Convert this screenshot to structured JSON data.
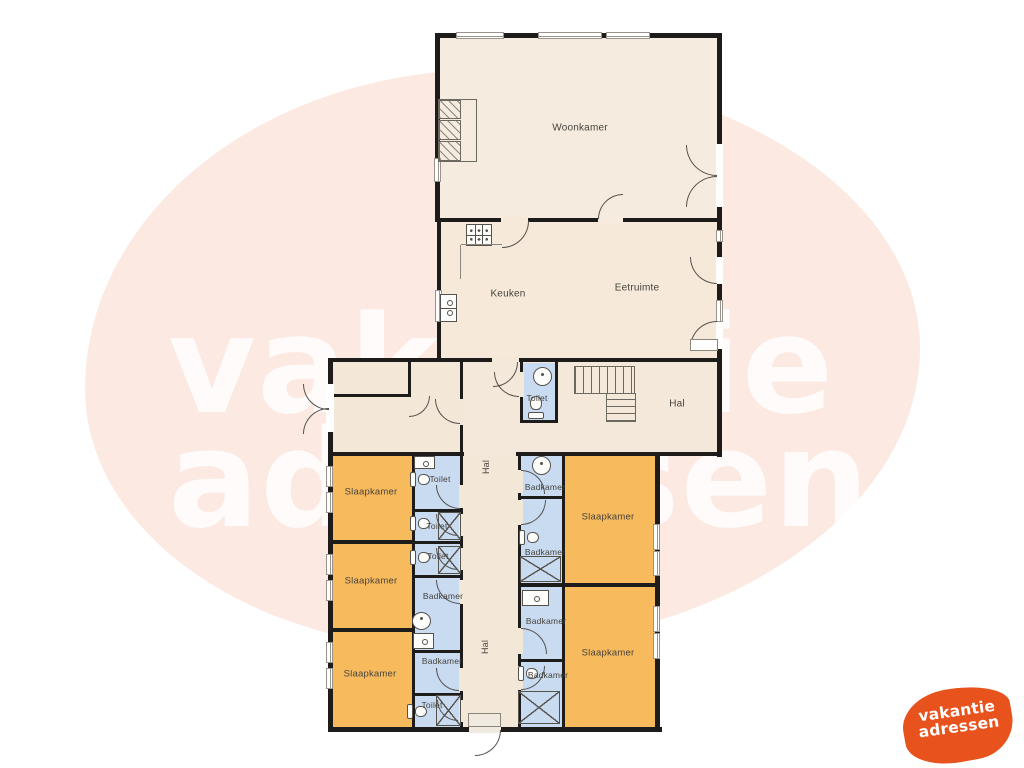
{
  "watermark": {
    "line1": "vakantie",
    "line2": "adressen",
    "color": "rgba(255,255,255,0.82)"
  },
  "background": {
    "blob_color": "#fbe9e2"
  },
  "logo": {
    "line1": "vakantie",
    "line2": "adressen",
    "shape_color": "#e8521c",
    "text_color": "#ffffff"
  },
  "palette": {
    "wall": "#1d1c1a",
    "floor_cream": "#f5ecdf",
    "floor_warm": "#f6e9d9",
    "floor_hall": "#f3e7d8",
    "bedroom_orange": "#f7bb5e",
    "bathroom_blue": "#c9dbf1"
  },
  "floorplan": {
    "rooms": [
      {
        "name": "woonkamer",
        "x": 438,
        "y": 36,
        "w": 281,
        "h": 184,
        "fill": "#f5ecdf"
      },
      {
        "name": "keuken-eetruimte",
        "x": 440,
        "y": 220,
        "w": 279,
        "h": 140,
        "fill": "#f6e9d9"
      },
      {
        "name": "hal-boven",
        "x": 461,
        "y": 360,
        "w": 258,
        "h": 94,
        "fill": "#f4e8da"
      },
      {
        "name": "entree",
        "x": 331,
        "y": 360,
        "w": 130,
        "h": 94,
        "fill": "#f3e7d8"
      },
      {
        "name": "toilet-midden",
        "x": 521,
        "y": 363,
        "w": 36,
        "h": 59,
        "fill": "#c9dbf1"
      },
      {
        "name": "hal-midden",
        "x": 461,
        "y": 454,
        "w": 59,
        "h": 275,
        "fill": "#f3e7d8"
      },
      {
        "name": "slaapkamer-1",
        "x": 331,
        "y": 454,
        "w": 83,
        "h": 88,
        "fill": "#f7bb5e"
      },
      {
        "name": "slaapkamer-2",
        "x": 331,
        "y": 542,
        "w": 83,
        "h": 88,
        "fill": "#f7bb5e"
      },
      {
        "name": "slaapkamer-3",
        "x": 331,
        "y": 632,
        "w": 83,
        "h": 97,
        "fill": "#f7bb5e"
      },
      {
        "name": "toilet-l1",
        "x": 413,
        "y": 454,
        "w": 49,
        "h": 57,
        "fill": "#c9dbf1"
      },
      {
        "name": "toilet-l2",
        "x": 413,
        "y": 511,
        "w": 49,
        "h": 32,
        "fill": "#c9dbf1"
      },
      {
        "name": "toilet-l3",
        "x": 413,
        "y": 543,
        "w": 49,
        "h": 34,
        "fill": "#c9dbf1"
      },
      {
        "name": "badkamer-l4",
        "x": 413,
        "y": 577,
        "w": 49,
        "h": 75,
        "fill": "#c9dbf1"
      },
      {
        "name": "badkamer-l5",
        "x": 413,
        "y": 652,
        "w": 49,
        "h": 43,
        "fill": "#c9dbf1"
      },
      {
        "name": "toilet-l6",
        "x": 413,
        "y": 695,
        "w": 49,
        "h": 34,
        "fill": "#c9dbf1"
      },
      {
        "name": "badkamer-r1",
        "x": 519,
        "y": 454,
        "w": 45,
        "h": 44,
        "fill": "#c9dbf1"
      },
      {
        "name": "badkamer-r2",
        "x": 519,
        "y": 498,
        "w": 45,
        "h": 87,
        "fill": "#c9dbf1"
      },
      {
        "name": "badkamer-r3",
        "x": 519,
        "y": 585,
        "w": 45,
        "h": 76,
        "fill": "#c9dbf1"
      },
      {
        "name": "badkamer-r4",
        "x": 519,
        "y": 661,
        "w": 45,
        "h": 68,
        "fill": "#c9dbf1"
      },
      {
        "name": "slaapkamer-4",
        "x": 563,
        "y": 454,
        "w": 93,
        "h": 130,
        "fill": "#f7bb5e"
      },
      {
        "name": "slaapkamer-5",
        "x": 563,
        "y": 584,
        "w": 93,
        "h": 145,
        "fill": "#f7bb5e"
      }
    ],
    "walls": [
      {
        "x": 435,
        "y": 33,
        "w": 287,
        "h": 5
      },
      {
        "x": 435,
        "y": 33,
        "w": 5,
        "h": 189
      },
      {
        "x": 437,
        "y": 220,
        "w": 4,
        "h": 142
      },
      {
        "x": 717,
        "y": 33,
        "w": 5,
        "h": 424
      },
      {
        "x": 435,
        "y": 218,
        "w": 284,
        "h": 4
      },
      {
        "x": 328,
        "y": 358,
        "w": 394,
        "h": 4
      },
      {
        "x": 328,
        "y": 358,
        "w": 5,
        "h": 374
      },
      {
        "x": 328,
        "y": 727,
        "w": 334,
        "h": 5
      },
      {
        "x": 655,
        "y": 455,
        "w": 5,
        "h": 276
      },
      {
        "x": 328,
        "y": 452,
        "w": 136,
        "h": 4
      },
      {
        "x": 516,
        "y": 452,
        "w": 206,
        "h": 4
      },
      {
        "x": 412,
        "y": 454,
        "w": 3,
        "h": 273
      },
      {
        "x": 460,
        "y": 358,
        "w": 3,
        "h": 369
      },
      {
        "x": 518,
        "y": 454,
        "w": 3,
        "h": 273
      },
      {
        "x": 562,
        "y": 454,
        "w": 3,
        "h": 273
      },
      {
        "x": 520,
        "y": 362,
        "w": 3,
        "h": 60
      },
      {
        "x": 555,
        "y": 362,
        "w": 3,
        "h": 60
      },
      {
        "x": 520,
        "y": 420,
        "w": 38,
        "h": 3
      },
      {
        "x": 408,
        "y": 360,
        "w": 3,
        "h": 36
      },
      {
        "x": 328,
        "y": 394,
        "w": 83,
        "h": 3
      },
      {
        "x": 412,
        "y": 509,
        "w": 50,
        "h": 3
      },
      {
        "x": 412,
        "y": 541,
        "w": 50,
        "h": 3
      },
      {
        "x": 412,
        "y": 575,
        "w": 50,
        "h": 3
      },
      {
        "x": 412,
        "y": 650,
        "w": 50,
        "h": 3
      },
      {
        "x": 412,
        "y": 693,
        "w": 50,
        "h": 3
      },
      {
        "x": 328,
        "y": 540,
        "w": 87,
        "h": 4
      },
      {
        "x": 328,
        "y": 628,
        "w": 87,
        "h": 4
      },
      {
        "x": 518,
        "y": 496,
        "w": 47,
        "h": 3
      },
      {
        "x": 518,
        "y": 583,
        "w": 140,
        "h": 4
      },
      {
        "x": 518,
        "y": 659,
        "w": 47,
        "h": 3
      }
    ],
    "gaps": [
      {
        "x": 501,
        "y": 217,
        "w": 27,
        "h": 6,
        "fill": "#f6e9d9"
      },
      {
        "x": 598,
        "y": 217,
        "w": 25,
        "h": 6,
        "fill": "#f5ecdf"
      },
      {
        "x": 492,
        "y": 357,
        "w": 27,
        "h": 6,
        "fill": "#f4e8da"
      },
      {
        "x": 519,
        "y": 372,
        "w": 5,
        "h": 25,
        "fill": "#f4e8da"
      },
      {
        "x": 459,
        "y": 399,
        "w": 6,
        "h": 26,
        "fill": "#f3e7d8"
      },
      {
        "x": 459,
        "y": 485,
        "w": 6,
        "h": 23,
        "fill": "#f3e7d8"
      },
      {
        "x": 459,
        "y": 514,
        "w": 6,
        "h": 22,
        "fill": "#f3e7d8"
      },
      {
        "x": 459,
        "y": 548,
        "w": 6,
        "h": 22,
        "fill": "#f3e7d8"
      },
      {
        "x": 459,
        "y": 580,
        "w": 6,
        "h": 24,
        "fill": "#f3e7d8"
      },
      {
        "x": 459,
        "y": 668,
        "w": 6,
        "h": 23,
        "fill": "#f3e7d8"
      },
      {
        "x": 459,
        "y": 700,
        "w": 6,
        "h": 22,
        "fill": "#f3e7d8"
      },
      {
        "x": 517,
        "y": 470,
        "w": 6,
        "h": 23,
        "fill": "#f3e7d8"
      },
      {
        "x": 517,
        "y": 500,
        "w": 6,
        "h": 25,
        "fill": "#f3e7d8"
      },
      {
        "x": 517,
        "y": 628,
        "w": 6,
        "h": 26,
        "fill": "#f3e7d8"
      },
      {
        "x": 517,
        "y": 666,
        "w": 6,
        "h": 24,
        "fill": "#f3e7d8"
      },
      {
        "x": 326,
        "y": 384,
        "w": 8,
        "h": 48,
        "fill": "#ffffff"
      },
      {
        "x": 716,
        "y": 144,
        "w": 7,
        "h": 63,
        "fill": "#ffffff"
      },
      {
        "x": 716,
        "y": 257,
        "w": 7,
        "h": 27,
        "fill": "#ffffff"
      },
      {
        "x": 716,
        "y": 322,
        "w": 7,
        "h": 27,
        "fill": "#ffffff"
      },
      {
        "x": 469,
        "y": 725,
        "w": 32,
        "h": 8,
        "fill": "#f0e9df"
      }
    ],
    "windows": [
      {
        "x": 456,
        "y": 32,
        "w": 48,
        "h": 7
      },
      {
        "x": 538,
        "y": 32,
        "w": 64,
        "h": 7
      },
      {
        "x": 606,
        "y": 32,
        "w": 44,
        "h": 7
      },
      {
        "x": 434,
        "y": 158,
        "w": 7,
        "h": 24
      },
      {
        "x": 435,
        "y": 290,
        "w": 7,
        "h": 32
      },
      {
        "x": 716,
        "y": 230,
        "w": 7,
        "h": 12
      },
      {
        "x": 716,
        "y": 300,
        "w": 7,
        "h": 22
      },
      {
        "x": 326,
        "y": 466,
        "w": 7,
        "h": 21
      },
      {
        "x": 326,
        "y": 492,
        "w": 7,
        "h": 21
      },
      {
        "x": 326,
        "y": 554,
        "w": 7,
        "h": 21
      },
      {
        "x": 326,
        "y": 580,
        "w": 7,
        "h": 21
      },
      {
        "x": 326,
        "y": 642,
        "w": 7,
        "h": 21
      },
      {
        "x": 326,
        "y": 668,
        "w": 7,
        "h": 21
      },
      {
        "x": 653,
        "y": 524,
        "w": 7,
        "h": 26
      },
      {
        "x": 653,
        "y": 551,
        "w": 7,
        "h": 25
      },
      {
        "x": 653,
        "y": 606,
        "w": 7,
        "h": 26
      },
      {
        "x": 653,
        "y": 633,
        "w": 7,
        "h": 26
      }
    ],
    "doors": [
      {
        "x": 303,
        "y": 384,
        "s": 26,
        "hinge": "tr"
      },
      {
        "x": 303,
        "y": 408,
        "s": 26,
        "hinge": "br"
      },
      {
        "x": 435,
        "y": 399,
        "s": 25,
        "hinge": "tr"
      },
      {
        "x": 409,
        "y": 396,
        "s": 21,
        "hinge": "tl"
      },
      {
        "x": 493,
        "y": 362,
        "s": 25,
        "hinge": "tl"
      },
      {
        "x": 502,
        "y": 221,
        "s": 27,
        "hinge": "tl"
      },
      {
        "x": 598,
        "y": 194,
        "s": 25,
        "hinge": "br"
      },
      {
        "x": 686,
        "y": 145,
        "s": 31,
        "hinge": "tr"
      },
      {
        "x": 686,
        "y": 176,
        "s": 31,
        "hinge": "br"
      },
      {
        "x": 690,
        "y": 257,
        "s": 27,
        "hinge": "tr"
      },
      {
        "x": 690,
        "y": 321,
        "s": 27,
        "hinge": "br"
      },
      {
        "x": 494,
        "y": 372,
        "s": 25,
        "hinge": "tr"
      },
      {
        "x": 436,
        "y": 485,
        "s": 24,
        "hinge": "tr"
      },
      {
        "x": 436,
        "y": 514,
        "s": 22,
        "hinge": "tr"
      },
      {
        "x": 436,
        "y": 548,
        "s": 22,
        "hinge": "tr"
      },
      {
        "x": 436,
        "y": 580,
        "s": 24,
        "hinge": "tr"
      },
      {
        "x": 436,
        "y": 668,
        "s": 23,
        "hinge": "tr"
      },
      {
        "x": 437,
        "y": 700,
        "s": 21,
        "hinge": "tr"
      },
      {
        "x": 521,
        "y": 470,
        "s": 24,
        "hinge": "bl"
      },
      {
        "x": 521,
        "y": 500,
        "s": 25,
        "hinge": "tl"
      },
      {
        "x": 521,
        "y": 628,
        "s": 26,
        "hinge": "bl"
      },
      {
        "x": 521,
        "y": 666,
        "s": 24,
        "hinge": "tl"
      },
      {
        "x": 475,
        "y": 730,
        "s": 26,
        "hinge": "tl"
      }
    ],
    "fixtures": [
      {
        "type": "stove",
        "x": 466,
        "y": 224,
        "w": 26,
        "h": 22
      },
      {
        "type": "line",
        "x": 461,
        "y": 244,
        "w": 41,
        "h": 1
      },
      {
        "type": "line",
        "x": 460,
        "y": 245,
        "w": 1,
        "h": 34
      },
      {
        "type": "ksink",
        "x": 440,
        "y": 294,
        "w": 17,
        "h": 28
      },
      {
        "type": "outline",
        "x": 438,
        "y": 99,
        "w": 39,
        "h": 63
      },
      {
        "type": "hatch",
        "x": 439,
        "y": 100,
        "w": 22,
        "h": 19
      },
      {
        "type": "hatch",
        "x": 439,
        "y": 120,
        "w": 22,
        "h": 20
      },
      {
        "type": "hatch",
        "x": 439,
        "y": 141,
        "w": 22,
        "h": 20
      },
      {
        "type": "stairs-v",
        "x": 574,
        "y": 366,
        "w": 61,
        "h": 28
      },
      {
        "type": "stairs-h",
        "x": 606,
        "y": 393,
        "w": 30,
        "h": 29
      },
      {
        "type": "step",
        "x": 690,
        "y": 339,
        "w": 28,
        "h": 12
      },
      {
        "type": "sill",
        "x": 468,
        "y": 713,
        "w": 33,
        "h": 14
      },
      {
        "type": "sink-round",
        "x": 533,
        "y": 367,
        "w": 19,
        "h": 19
      },
      {
        "type": "wc",
        "x": 528,
        "y": 396,
        "w": 17,
        "h": 23,
        "rot": 0
      },
      {
        "type": "sink",
        "x": 414,
        "y": 456,
        "w": 21,
        "h": 13
      },
      {
        "type": "wc",
        "x": 412,
        "y": 470,
        "w": 16,
        "h": 20,
        "rot": 90
      },
      {
        "type": "wc",
        "x": 412,
        "y": 514,
        "w": 16,
        "h": 20,
        "rot": 90
      },
      {
        "type": "shower",
        "x": 438,
        "y": 512,
        "w": 23,
        "h": 28
      },
      {
        "type": "wc",
        "x": 412,
        "y": 548,
        "w": 16,
        "h": 20,
        "rot": 90
      },
      {
        "type": "shower",
        "x": 438,
        "y": 546,
        "w": 23,
        "h": 28
      },
      {
        "type": "sink-round",
        "x": 412,
        "y": 612,
        "w": 19,
        "h": 18
      },
      {
        "type": "sink",
        "x": 413,
        "y": 633,
        "w": 21,
        "h": 16
      },
      {
        "type": "wc",
        "x": 409,
        "y": 702,
        "w": 16,
        "h": 20,
        "rot": 90
      },
      {
        "type": "shower",
        "x": 436,
        "y": 695,
        "w": 25,
        "h": 31
      },
      {
        "type": "sink-round",
        "x": 532,
        "y": 456,
        "w": 19,
        "h": 19
      },
      {
        "type": "wc",
        "x": 521,
        "y": 528,
        "w": 16,
        "h": 20,
        "rot": 90
      },
      {
        "type": "shower",
        "x": 520,
        "y": 556,
        "w": 41,
        "h": 26
      },
      {
        "type": "sink",
        "x": 522,
        "y": 590,
        "w": 27,
        "h": 16
      },
      {
        "type": "wc",
        "x": 520,
        "y": 664,
        "w": 16,
        "h": 20,
        "rot": 90
      },
      {
        "type": "shower",
        "x": 518,
        "y": 691,
        "w": 42,
        "h": 33
      }
    ],
    "labels": [
      {
        "text": "Woonkamer",
        "x": 580,
        "y": 128,
        "fs": 10
      },
      {
        "text": "Keuken",
        "x": 508,
        "y": 294,
        "fs": 10
      },
      {
        "text": "Eetruimte",
        "x": 637,
        "y": 288,
        "fs": 10
      },
      {
        "text": "Toilet",
        "x": 537,
        "y": 398,
        "fs": 8.5
      },
      {
        "text": "Hal",
        "x": 677,
        "y": 404,
        "fs": 10
      },
      {
        "text": "Hal",
        "x": 486,
        "y": 467,
        "fs": 9,
        "vertical": true
      },
      {
        "text": "Hal",
        "x": 485,
        "y": 647,
        "fs": 9,
        "vertical": true
      },
      {
        "text": "Slaapkamer",
        "x": 371,
        "y": 492,
        "fs": 9.5
      },
      {
        "text": "Slaapkamer",
        "x": 371,
        "y": 581,
        "fs": 9.5
      },
      {
        "text": "Slaapkamer",
        "x": 370,
        "y": 674,
        "fs": 9.5
      },
      {
        "text": "Slaapkamer",
        "x": 608,
        "y": 517,
        "fs": 9.5
      },
      {
        "text": "Slaapkamer",
        "x": 608,
        "y": 653,
        "fs": 9.5
      },
      {
        "text": "Toilet",
        "x": 440,
        "y": 479,
        "fs": 8.5
      },
      {
        "text": "Toilet",
        "x": 437,
        "y": 526,
        "fs": 8.5
      },
      {
        "text": "Toilet",
        "x": 438,
        "y": 556,
        "fs": 8.5
      },
      {
        "text": "Badkamer",
        "x": 443,
        "y": 596,
        "fs": 8.5
      },
      {
        "text": "Badkamer",
        "x": 442,
        "y": 661,
        "fs": 8.5
      },
      {
        "text": "Toilet",
        "x": 432,
        "y": 705,
        "fs": 8.5
      },
      {
        "text": "Badkamer",
        "x": 545,
        "y": 487,
        "fs": 8.5
      },
      {
        "text": "Badkamer",
        "x": 545,
        "y": 552,
        "fs": 8.5
      },
      {
        "text": "Badkamer",
        "x": 546,
        "y": 621,
        "fs": 8.5
      },
      {
        "text": "Badkamer",
        "x": 548,
        "y": 675,
        "fs": 8.5
      }
    ]
  }
}
